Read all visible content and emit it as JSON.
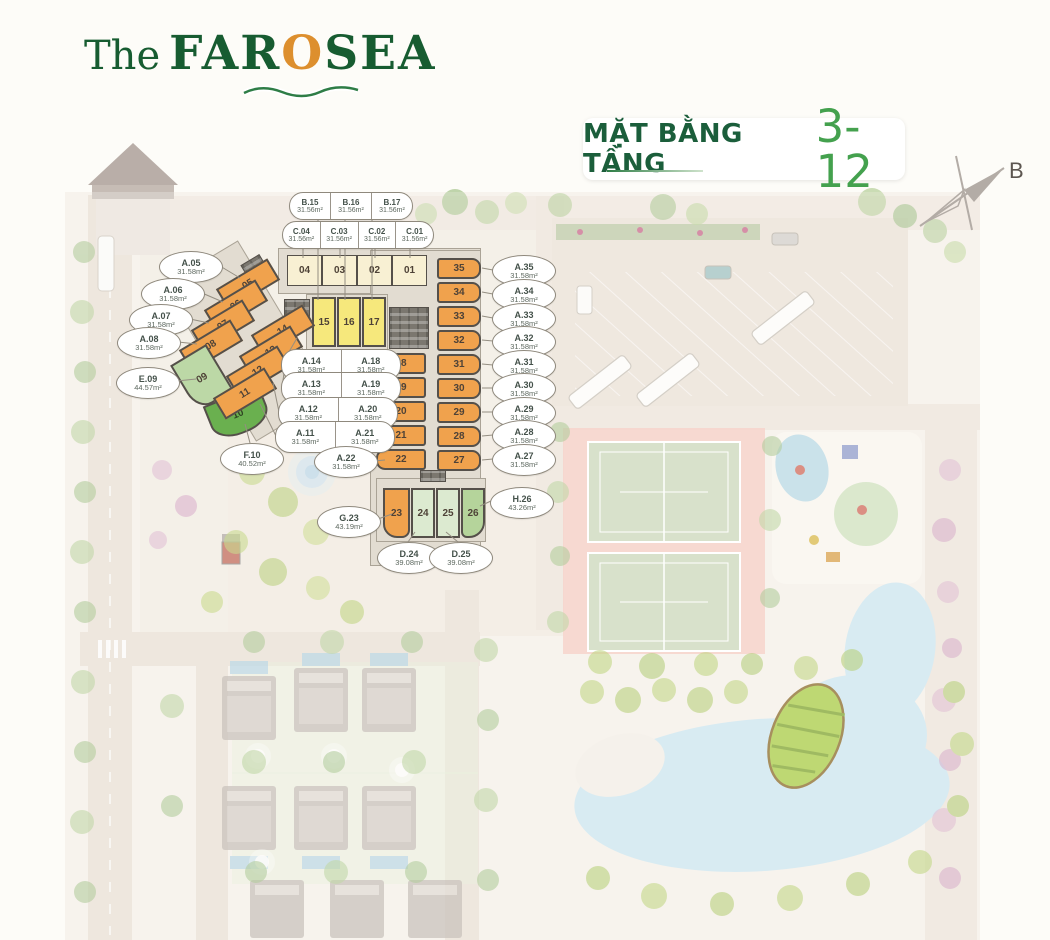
{
  "logo": {
    "prefix": "The",
    "brand_far": "FAR",
    "brand_o": "O",
    "brand_sea": "SEA"
  },
  "title": {
    "label": "MẶT BẰNG TẦNG",
    "floors": "3-12"
  },
  "compass": {
    "north": "B"
  },
  "accent_colors": {
    "brand_green": "#1b5e3b",
    "floors_green": "#44a14e",
    "logo_orange": "#dd8f2e",
    "unit_orange": "#f0a24d",
    "unit_cream": "#f8f0d3",
    "unit_yellow": "#f6e87c",
    "unit_green": "#6ab04f",
    "unit_light_green": "#bcd8a6",
    "unit_pale_green": "#dcead0",
    "tennis_salmon": "#f5c6bb",
    "pool_blue": "#cbe4ee"
  },
  "labels": {
    "B15": {
      "id": "B.15",
      "area": "31.56m²"
    },
    "B16": {
      "id": "B.16",
      "area": "31.56m²"
    },
    "B17": {
      "id": "B.17",
      "area": "31.56m²"
    },
    "C04": {
      "id": "C.04",
      "area": "31.56m²"
    },
    "C03": {
      "id": "C.03",
      "area": "31.56m²"
    },
    "C02": {
      "id": "C.02",
      "area": "31.56m²"
    },
    "C01": {
      "id": "C.01",
      "area": "31.56m²"
    },
    "A05": {
      "id": "A.05",
      "area": "31.58m²"
    },
    "A06": {
      "id": "A.06",
      "area": "31.58m²"
    },
    "A07": {
      "id": "A.07",
      "area": "31.58m²"
    },
    "A08": {
      "id": "A.08",
      "area": "31.58m²"
    },
    "E09": {
      "id": "E.09",
      "area": "44.57m²"
    },
    "F10": {
      "id": "F.10",
      "area": "40.52m²"
    },
    "A11": {
      "id": "A.11",
      "area": "31.58m²"
    },
    "A12": {
      "id": "A.12",
      "area": "31.58m²"
    },
    "A13": {
      "id": "A.13",
      "area": "31.58m²"
    },
    "A14": {
      "id": "A.14",
      "area": "31.58m²"
    },
    "A18": {
      "id": "A.18",
      "area": "31.58m²"
    },
    "A19": {
      "id": "A.19",
      "area": "31.58m²"
    },
    "A20": {
      "id": "A.20",
      "area": "31.58m²"
    },
    "A21": {
      "id": "A.21",
      "area": "31.58m²"
    },
    "A22": {
      "id": "A.22",
      "area": "31.58m²"
    },
    "G23": {
      "id": "G.23",
      "area": "43.19m²"
    },
    "D24": {
      "id": "D.24",
      "area": "39.08m²"
    },
    "D25": {
      "id": "D.25",
      "area": "39.08m²"
    },
    "H26": {
      "id": "H.26",
      "area": "43.26m²"
    },
    "A27": {
      "id": "A.27",
      "area": "31.58m²"
    },
    "A28": {
      "id": "A.28",
      "area": "31.58m²"
    },
    "A29": {
      "id": "A.29",
      "area": "31.58m²"
    },
    "A30": {
      "id": "A.30",
      "area": "31.58m²"
    },
    "A31": {
      "id": "A.31",
      "area": "31.58m²"
    },
    "A32": {
      "id": "A.32",
      "area": "31.58m²"
    },
    "A33": {
      "id": "A.33",
      "area": "31.58m²"
    },
    "A34": {
      "id": "A.34",
      "area": "31.58m²"
    },
    "A35": {
      "id": "A.35",
      "area": "31.58m²"
    }
  },
  "blocks": {
    "n01": "01",
    "n02": "02",
    "n03": "03",
    "n04": "04",
    "n05": "05",
    "n06": "06",
    "n07": "07",
    "n08": "08",
    "n09": "09",
    "n10": "10",
    "n11": "11",
    "n12": "12",
    "n13": "13",
    "n14": "14",
    "n15": "15",
    "n16": "16",
    "n17": "17",
    "n18": "18",
    "n19": "19",
    "n20": "20",
    "n21": "21",
    "n22": "22",
    "n23": "23",
    "n24": "24",
    "n25": "25",
    "n26": "26",
    "n27": "27",
    "n28": "28",
    "n29": "29",
    "n30": "30",
    "n31": "31",
    "n32": "32",
    "n33": "33",
    "n34": "34",
    "n35": "35"
  }
}
